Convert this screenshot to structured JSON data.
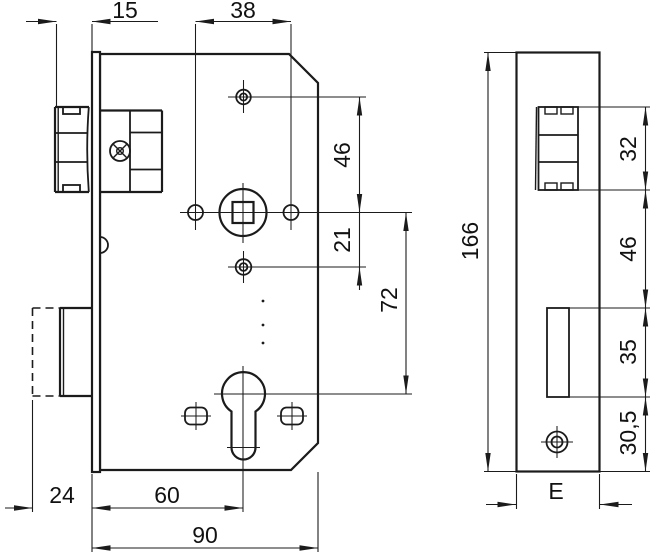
{
  "colors": {
    "line": "#1b1b1b",
    "text": "#111111",
    "background": "#ffffff"
  },
  "dims": {
    "latch_protrusion": "15",
    "hole_spacing": "38",
    "hole_to_spindle": "46",
    "spindle_to_lower_hole": "21",
    "spindle_to_cylinder": "72",
    "bolt_throw": "24",
    "backset": "60",
    "case_depth": "90",
    "faceplate_length": "166",
    "latch_cutout": "32",
    "latch_to_bolt_cutout": "46",
    "bolt_cutout": "35",
    "bolt_cutout_to_bottom": "30,5",
    "faceplate_width": "E"
  }
}
